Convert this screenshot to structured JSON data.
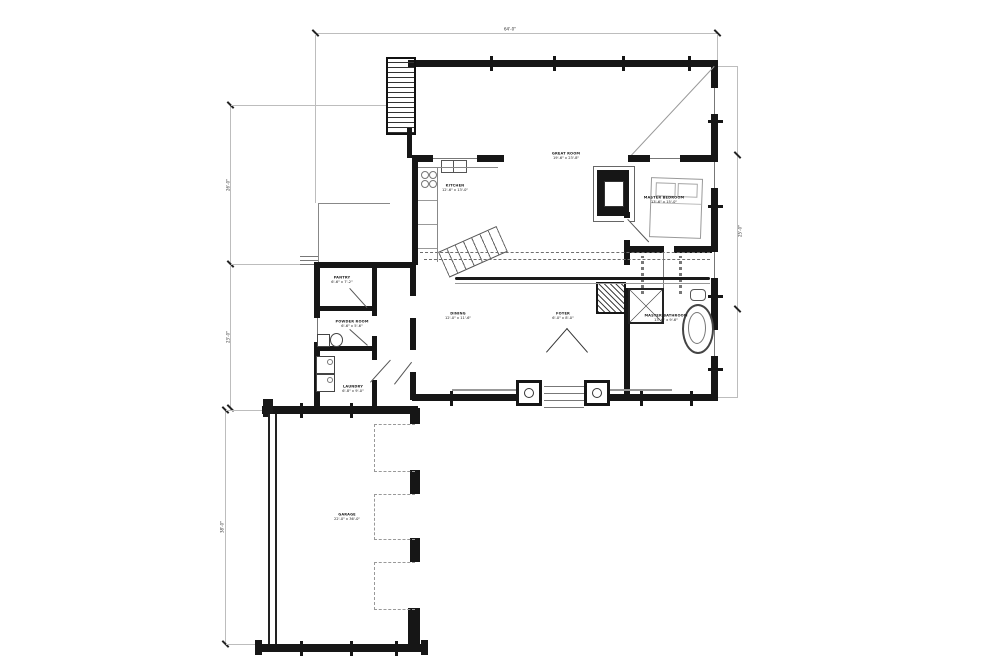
{
  "plan": {
    "rooms": [
      {
        "id": "great-room",
        "name": "GREAT ROOM",
        "dims": "19'-6\" x 23'-8\""
      },
      {
        "id": "kitchen",
        "name": "KITCHEN",
        "dims": "12'-6\" x 13'-0\""
      },
      {
        "id": "master-bedroom",
        "name": "MASTER BEDROOM",
        "dims": "13'-6\" x 15'-0\""
      },
      {
        "id": "dining",
        "name": "DINING",
        "dims": "12'-0\" x 11'-6\""
      },
      {
        "id": "foyer",
        "name": "FOYER",
        "dims": "6'-0\" x 8'-0\""
      },
      {
        "id": "master-bathroom",
        "name": "MASTER BATHROOM",
        "dims": "13'-6\" x 9'-6\""
      },
      {
        "id": "pantry",
        "name": "PANTRY",
        "dims": "6'-6\" x 7'-2\""
      },
      {
        "id": "powder-room",
        "name": "POWDER ROOM",
        "dims": "6'-6\" x 5'-6\""
      },
      {
        "id": "laundry",
        "name": "LAUNDRY",
        "dims": "6'-8\" x 9'-0\""
      },
      {
        "id": "garage",
        "name": "GARAGE",
        "dims": "22'-0\" x 36'-0\""
      }
    ],
    "dims": {
      "top": "64'-0\"",
      "left_upper": "26'-0\"",
      "left_middle": "23'-0\"",
      "left_lower": "38'-0\"",
      "right": "25'-0\""
    },
    "colors": {
      "wall": "#161616",
      "dimension": "#bdbdbd",
      "sketch": "#555",
      "paper": "#ffffff"
    }
  }
}
